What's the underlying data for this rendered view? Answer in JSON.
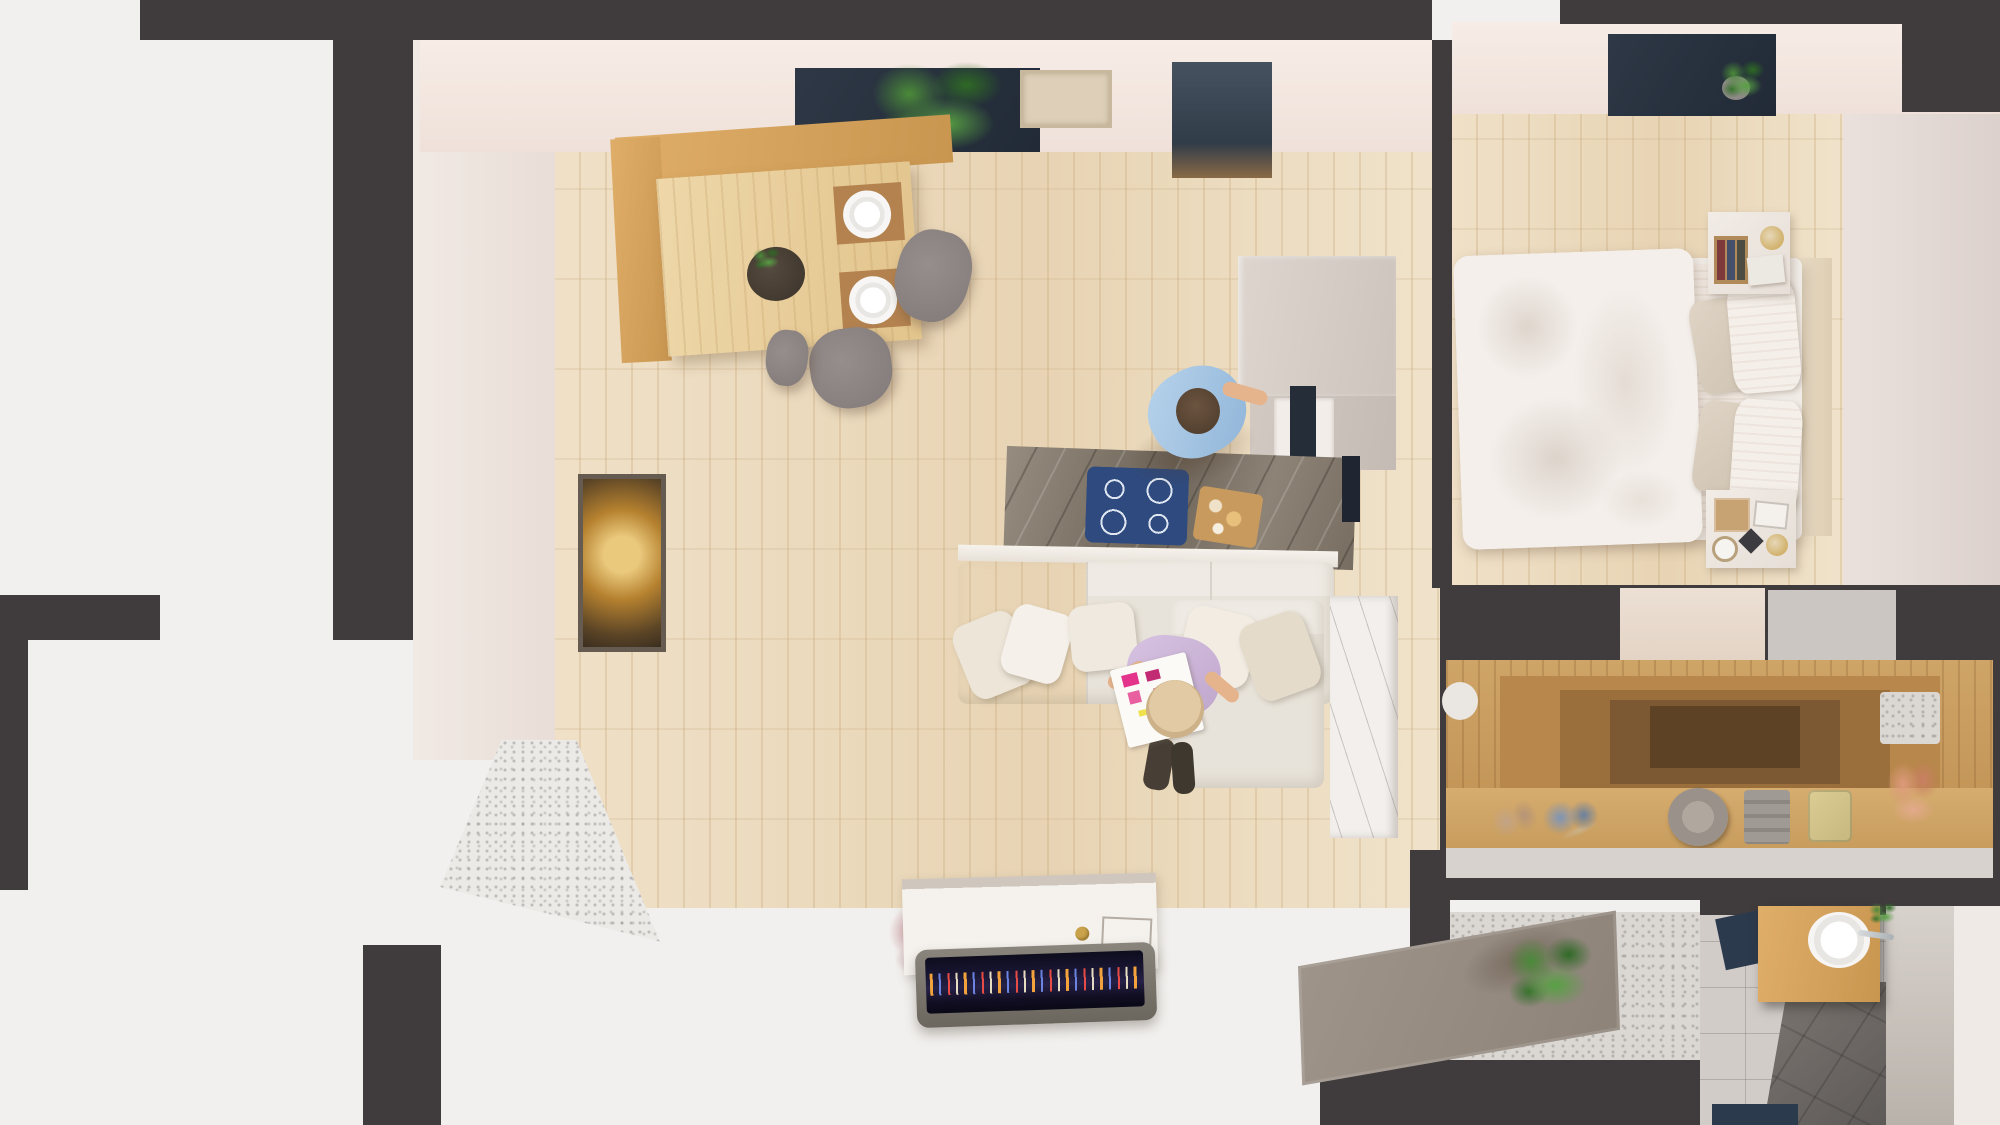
{
  "title": "Top-down 3D render of a one-bedroom apartment floor plan",
  "palette": {
    "wall": "#403c3d",
    "floorWood": "#ecdcc0",
    "benchWood": "#d9a660",
    "marble": "#877d70",
    "windowNavy": "#28313c",
    "cooktopBlue": "#2e4a7e",
    "sofaCream": "#e9e4dc",
    "duvetWhite": "#f3eeea",
    "tile": "#d2ccc8",
    "showerGray": "#6b6765",
    "matNavy": "#2c3a4d",
    "doormatTaupe": "#978d83",
    "accentGold": "#c9a24b",
    "tvScreen": "#141226",
    "plantGreen": "#3f7a33",
    "skin": "#e6b48c",
    "shirtBlue": "#a6c6e4",
    "topLavender": "#cdb7d8"
  },
  "rooms": [
    {
      "id": "living-dining-kitchen",
      "name": "open living / dining / kitchen",
      "items": [
        "corner bench",
        "dining table",
        "dinner plates",
        "centerpiece bowl",
        "dining chairs",
        "window plant",
        "wall picture",
        "kitchen island with marble top",
        "induction cooktop",
        "cutting board",
        "tall kitchen cabinets",
        "standing person cooking",
        "cream sectional sofa",
        "throw pillows",
        "seated person reading magazine",
        "tall white cabinet with branch decal",
        "white sideboard",
        "television with city skyline",
        "dried flowers",
        "framed city artwork",
        "balcony threshold"
      ]
    },
    {
      "id": "bedroom",
      "name": "bedroom",
      "items": [
        "double bed with rumpled duvet",
        "striped sheet",
        "two white pillows",
        "two beige pillows",
        "headboard",
        "nightstand with books and lamp",
        "nightstand with clock and frames",
        "window succulent"
      ]
    },
    {
      "id": "hallway-closet",
      "name": "hallway with open wardrobe",
      "items": [
        "open wardrobe shelving",
        "beige shoes",
        "blue shoes",
        "hat",
        "folded clothes",
        "yellow bag",
        "coral dried flowers",
        "gray towel",
        "entry doormat",
        "entry plant"
      ]
    },
    {
      "id": "bathroom",
      "name": "bathroom",
      "items": [
        "wooden vanity",
        "round sink with faucet",
        "walk-in shower",
        "navy bath mats",
        "mirror panel"
      ]
    }
  ]
}
